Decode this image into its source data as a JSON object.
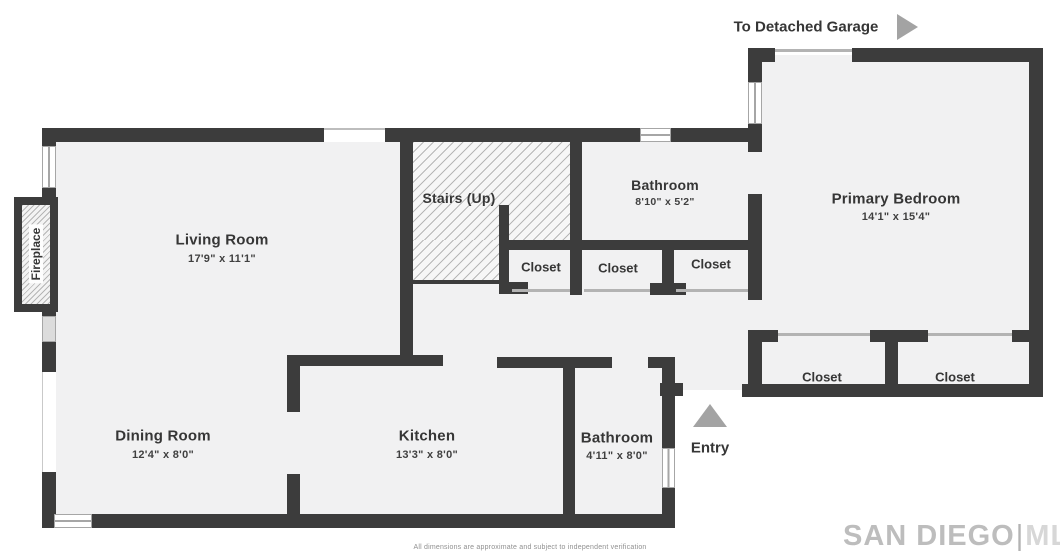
{
  "rooms": {
    "living_room": {
      "name": "Living Room",
      "dims": "17'9\" x 11'1\""
    },
    "dining_room": {
      "name": "Dining Room",
      "dims": "12'4\" x 8'0\""
    },
    "kitchen": {
      "name": "Kitchen",
      "dims": "13'3\" x 8'0\""
    },
    "bathroom_upper": {
      "name": "Bathroom",
      "dims": "8'10\" x 5'2\""
    },
    "bathroom_lower": {
      "name": "Bathroom",
      "dims": "4'11\" x 8'0\""
    },
    "primary_bedroom": {
      "name": "Primary Bedroom",
      "dims": "14'1\" x 15'4\""
    },
    "stairs": {
      "name": "Stairs (Up)"
    }
  },
  "closets": [
    {
      "label": "Closet"
    },
    {
      "label": "Closet"
    },
    {
      "label": "Closet"
    },
    {
      "label": "Closet"
    },
    {
      "label": "Closet"
    }
  ],
  "features": {
    "fireplace": "Fireplace",
    "entry": "Entry",
    "garage": "To Detached Garage"
  },
  "watermark": {
    "brand": "SAN DIEGO",
    "separator": "|",
    "suffix": "MLS"
  },
  "disclaimer": "All dimensions are approximate and subject to independent verification",
  "colors": {
    "wall": "#3c3c3c",
    "floor": "#f1f1f2",
    "arrow": "#a3a3a3",
    "watermark_brand": "#bdbdbd",
    "watermark_suffix": "#d7d7d7"
  }
}
